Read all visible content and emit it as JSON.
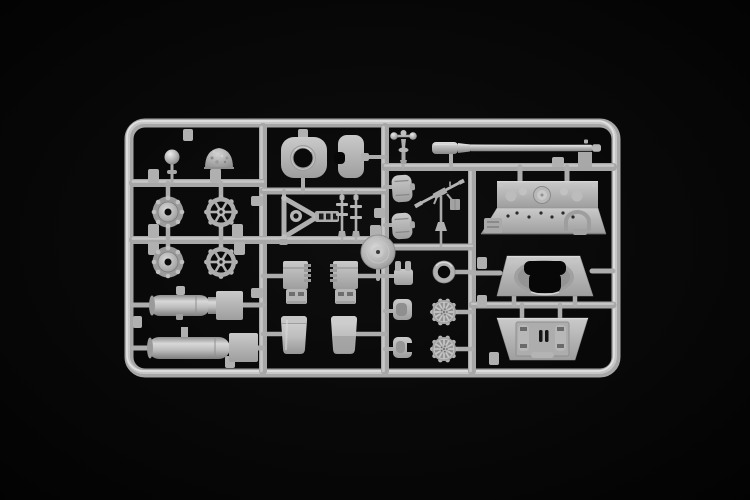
{
  "photo": {
    "type": "product-photograph",
    "subject": "plastic model kit sprue with tank parts",
    "colors": {
      "bg": "#050505",
      "bg-center": "#0d0d0d",
      "plastic": "#b4b4b4",
      "plastic-hi": "#dcdcdc",
      "plastic-shadow": "#8c8c8c",
      "hole": "#0a0a0a"
    },
    "frame_label": "sprue-frame",
    "parts": [
      {
        "label": "ball knob part"
      },
      {
        "label": "cast cupola dome"
      },
      {
        "label": "drive sprocket wheel upper"
      },
      {
        "label": "drive sprocket wheel lower"
      },
      {
        "label": "spoked idler wheel upper"
      },
      {
        "label": "spoked idler wheel lower"
      },
      {
        "label": "exhaust muffler upper"
      },
      {
        "label": "exhaust muffler lower"
      },
      {
        "label": "gun mantlet with bore"
      },
      {
        "label": "C-shaped mount bracket"
      },
      {
        "label": "triangular gun cradle"
      },
      {
        "label": "linkage rods"
      },
      {
        "label": "dished wheel disc"
      },
      {
        "label": "stowage box left"
      },
      {
        "label": "stowage box right"
      },
      {
        "label": "stowage drum left"
      },
      {
        "label": "stowage drum right"
      },
      {
        "label": "hatch cover upper"
      },
      {
        "label": "hatch cover lower"
      },
      {
        "label": "anti-aircraft machine gun on post"
      },
      {
        "label": "pivot mount with balls"
      },
      {
        "label": "pronged fitting"
      },
      {
        "label": "dished fitting"
      },
      {
        "label": "notched fitting"
      },
      {
        "label": "tire ring"
      },
      {
        "label": "ribbed road wheel upper"
      },
      {
        "label": "ribbed road wheel lower"
      },
      {
        "label": "tank gun barrel"
      },
      {
        "label": "engine deck plate"
      },
      {
        "label": "turret roof with hatch opening"
      },
      {
        "label": "hull plate with hinged hatch"
      }
    ]
  }
}
